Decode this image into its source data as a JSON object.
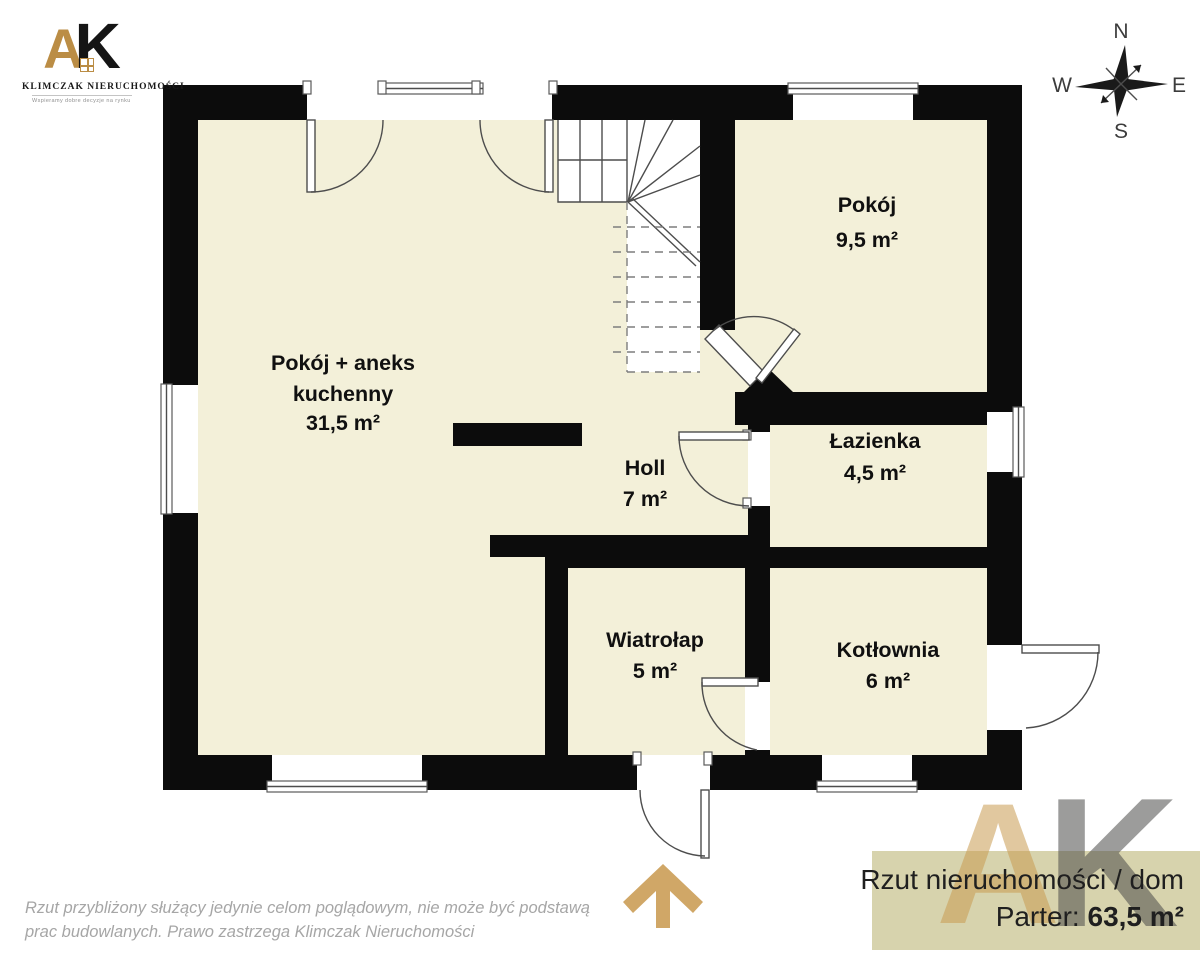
{
  "header_logo": {
    "letter_a": "A",
    "letter_k": "K",
    "company": "KLIMCZAK NIERUCHOMOŚCI",
    "tagline": "Wspieramy dobre decyzje na rynku nieruchomości"
  },
  "compass": {
    "north": "N",
    "south": "S",
    "east": "E",
    "west": "W"
  },
  "plan": {
    "rooms": [
      {
        "id": "living-kitchen",
        "line1": "Pokój + aneks",
        "line2": "kuchenny",
        "area": "31,5 m²"
      },
      {
        "id": "room",
        "line1": "Pokój",
        "area": "9,5 m²"
      },
      {
        "id": "bathroom",
        "line1": "Łazienka",
        "area": "4,5 m²"
      },
      {
        "id": "hall",
        "line1": "Holl",
        "area": "7 m²"
      },
      {
        "id": "vestibule",
        "line1": "Wiatrołap",
        "area": "5 m²"
      },
      {
        "id": "boiler",
        "line1": "Kotłownia",
        "area": "6 m²"
      }
    ]
  },
  "watermark": {
    "letter_a": "A",
    "letter_k": "K"
  },
  "banner": {
    "title": "Rzut nieruchomości / dom",
    "floor_label": "Parter:",
    "floor_area": "63,5 m²"
  },
  "disclaimer": {
    "line1": "Rzut przybliżony służący jedynie celom poglądowym, nie może być podstawą",
    "line2": "prac budowlanych. Prawo zastrzega Klimczak Nieruchomości"
  },
  "colors": {
    "floor": "#f3f0d9",
    "wall": "#0c0c0c",
    "accent_gold": "#d0a767",
    "banner_bg": "#d7d3ad",
    "disclaimer_gray": "#a6a6a6"
  }
}
